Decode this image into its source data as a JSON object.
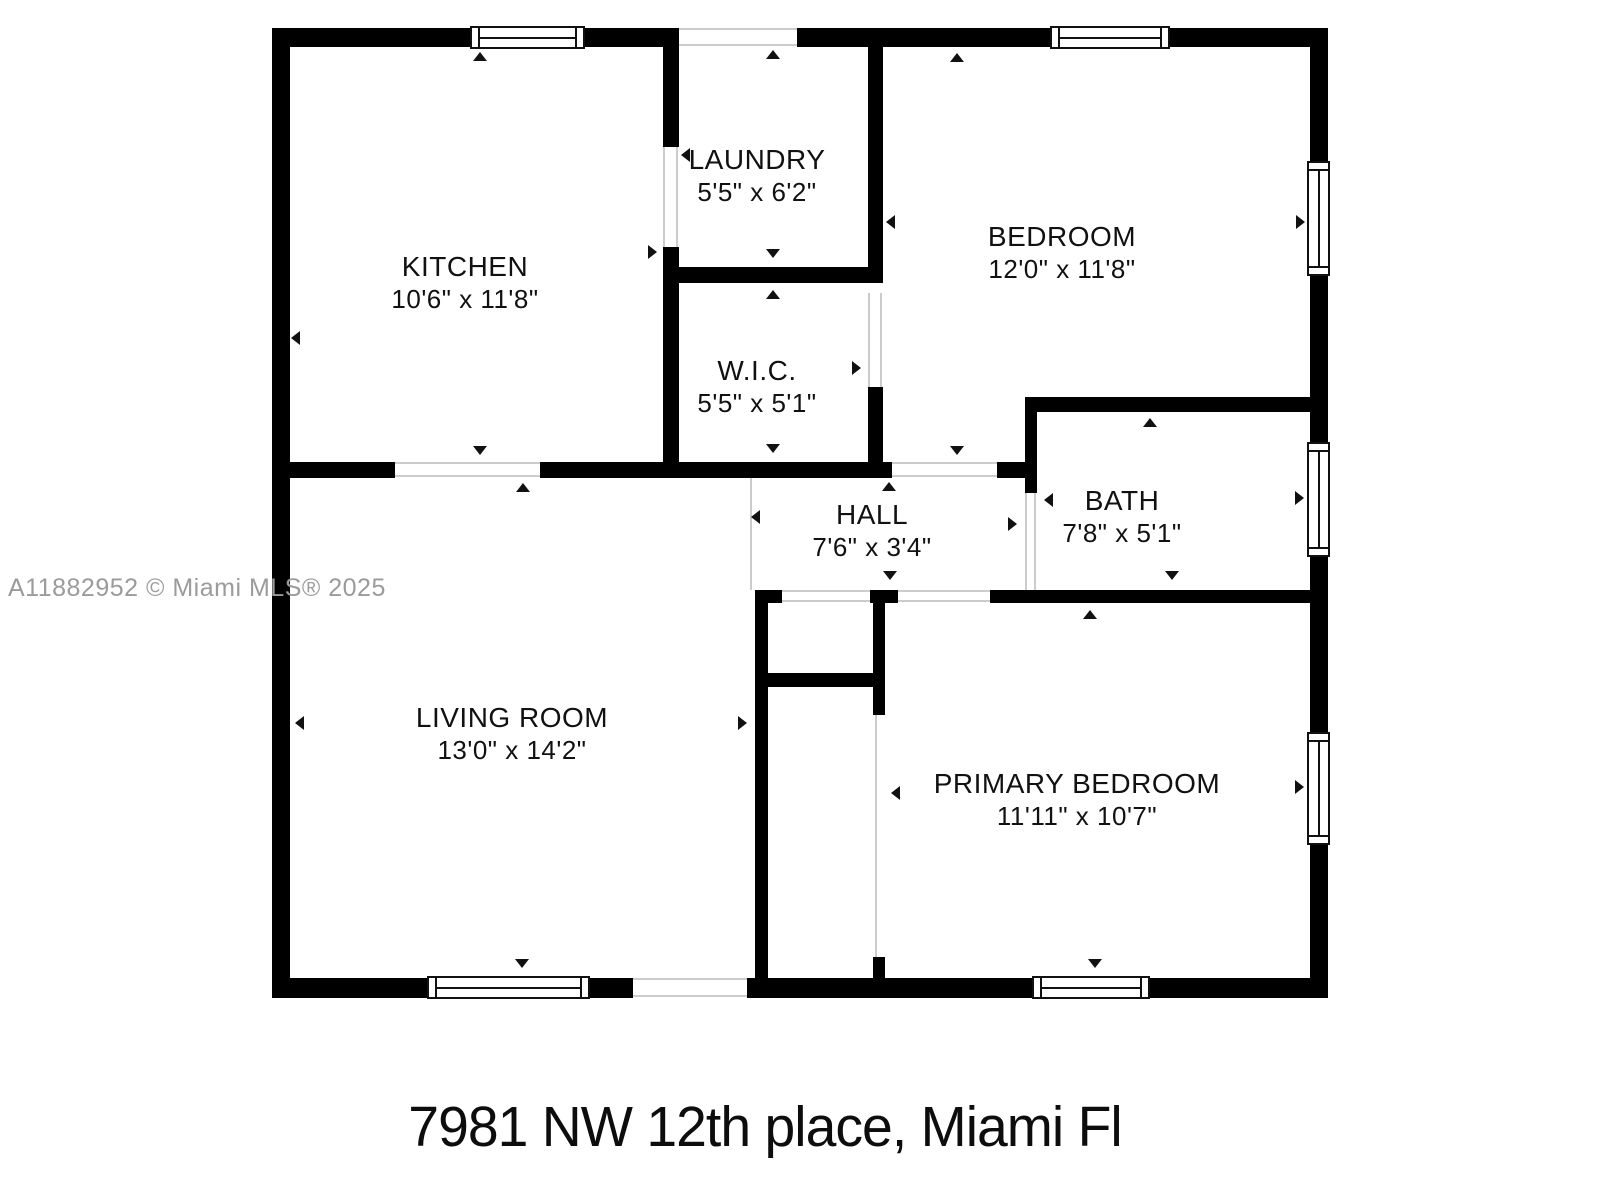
{
  "floorplan": {
    "watermark": "A11882952 © Miami MLS® 2025",
    "address": "7981 NW 12th place, Miami Fl",
    "colors": {
      "wall": "#000000",
      "watermark": "#9b9b9b",
      "background": "#ffffff"
    },
    "rooms": {
      "kitchen": {
        "name": "KITCHEN",
        "dims": "10'6\" x 11'8\""
      },
      "laundry": {
        "name": "LAUNDRY",
        "dims": "5'5\" x 6'2\""
      },
      "bedroom": {
        "name": "BEDROOM",
        "dims": "12'0\" x 11'8\""
      },
      "wic": {
        "name": "W.I.C.",
        "dims": "5'5\" x 5'1\""
      },
      "hall": {
        "name": "HALL",
        "dims": "7'6\" x 3'4\""
      },
      "bath": {
        "name": "BATH",
        "dims": "7'8\" x 5'1\""
      },
      "living": {
        "name": "LIVING ROOM",
        "dims": "13'0\" x 14'2\""
      },
      "primary": {
        "name": "PRIMARY BEDROOM",
        "dims": "11'11\" x 10'7\""
      }
    }
  }
}
